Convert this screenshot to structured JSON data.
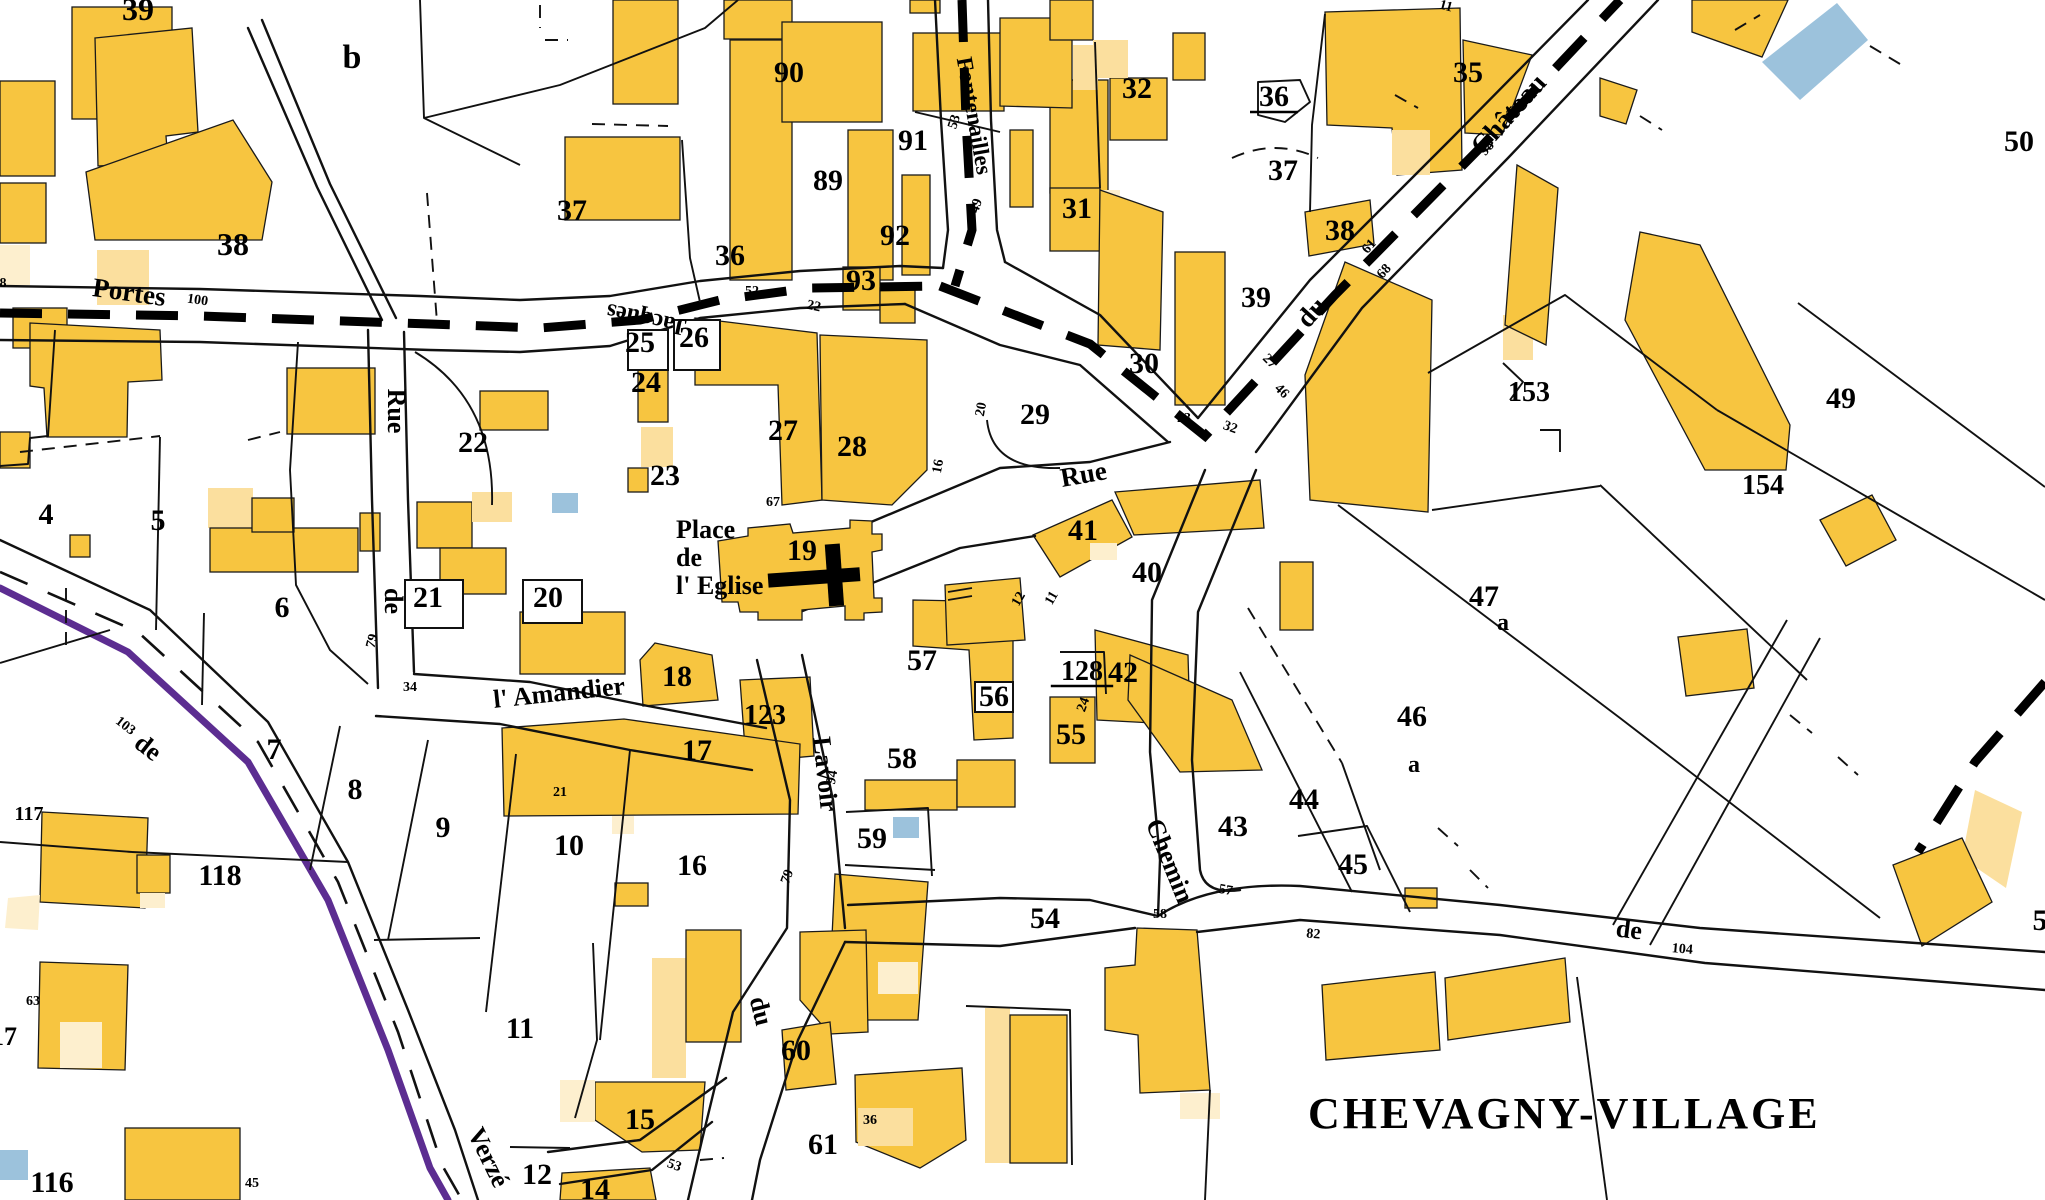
{
  "map": {
    "title": "CHEVAGNY-VILLAGE",
    "colors": {
      "building": "#F7C540",
      "building_light": "#FBDF9E",
      "building_pale": "#FDEFCE",
      "water": "#9CC2DC",
      "commune_boundary": "#5C2D91",
      "line": "#111111"
    },
    "place": {
      "lines": [
        "Place",
        "de",
        "l' Eglise"
      ]
    },
    "parcel_labels": [
      {
        "t": "39",
        "x": 138,
        "y": 20,
        "s": 32
      },
      {
        "t": "b",
        "x": 352,
        "y": 68,
        "s": 34
      },
      {
        "t": "38",
        "x": 233,
        "y": 255,
        "s": 32
      },
      {
        "t": "37",
        "x": 572,
        "y": 220
      },
      {
        "t": "37",
        "x": 1283,
        "y": 180
      },
      {
        "t": "32",
        "x": 1137,
        "y": 98
      },
      {
        "t": "36",
        "x": 1274,
        "y": 106,
        "u": 1
      },
      {
        "t": "35",
        "x": 1468,
        "y": 82
      },
      {
        "t": "38",
        "x": 1340,
        "y": 240
      },
      {
        "t": "31",
        "x": 1077,
        "y": 218
      },
      {
        "t": "39",
        "x": 1256,
        "y": 307
      },
      {
        "t": "30",
        "x": 1144,
        "y": 373
      },
      {
        "t": "90",
        "x": 789,
        "y": 82
      },
      {
        "t": "91",
        "x": 913,
        "y": 150
      },
      {
        "t": "89",
        "x": 828,
        "y": 190
      },
      {
        "t": "92",
        "x": 895,
        "y": 245
      },
      {
        "t": "93",
        "x": 861,
        "y": 290
      },
      {
        "t": "36",
        "x": 730,
        "y": 265
      },
      {
        "t": "25",
        "x": 640,
        "y": 352
      },
      {
        "t": "26",
        "x": 694,
        "y": 347
      },
      {
        "t": "24",
        "x": 646,
        "y": 392
      },
      {
        "t": "23",
        "x": 665,
        "y": 485
      },
      {
        "t": "27",
        "x": 783,
        "y": 440
      },
      {
        "t": "28",
        "x": 852,
        "y": 456
      },
      {
        "t": "29",
        "x": 1035,
        "y": 424
      },
      {
        "t": "22",
        "x": 473,
        "y": 452
      },
      {
        "t": "21",
        "x": 428,
        "y": 607
      },
      {
        "t": "20",
        "x": 548,
        "y": 607
      },
      {
        "t": "19",
        "x": 802,
        "y": 560
      },
      {
        "t": "18",
        "x": 677,
        "y": 686
      },
      {
        "t": "123",
        "x": 765,
        "y": 724,
        "s": 28
      },
      {
        "t": "17",
        "x": 697,
        "y": 760
      },
      {
        "t": "57",
        "x": 922,
        "y": 670
      },
      {
        "t": "56",
        "x": 994,
        "y": 706
      },
      {
        "t": "58",
        "x": 902,
        "y": 768
      },
      {
        "t": "55",
        "x": 1071,
        "y": 744
      },
      {
        "t": "128",
        "x": 1082,
        "y": 680,
        "s": 28,
        "u": 1
      },
      {
        "t": "42",
        "x": 1123,
        "y": 682
      },
      {
        "t": "41",
        "x": 1083,
        "y": 540
      },
      {
        "t": "40",
        "x": 1147,
        "y": 582
      },
      {
        "t": "153",
        "x": 1529,
        "y": 401,
        "s": 28
      },
      {
        "t": "154",
        "x": 1763,
        "y": 494,
        "s": 28
      },
      {
        "t": "49",
        "x": 1841,
        "y": 408
      },
      {
        "t": "50",
        "x": 2019,
        "y": 151
      },
      {
        "t": "47",
        "x": 1484,
        "y": 606
      },
      {
        "t": "a",
        "x": 1503,
        "y": 630,
        "s": 24
      },
      {
        "t": "46",
        "x": 1412,
        "y": 726
      },
      {
        "t": "a",
        "x": 1414,
        "y": 772,
        "s": 24
      },
      {
        "t": "43",
        "x": 1233,
        "y": 836
      },
      {
        "t": "44",
        "x": 1304,
        "y": 809
      },
      {
        "t": "45",
        "x": 1353,
        "y": 874
      },
      {
        "t": "59",
        "x": 872,
        "y": 848
      },
      {
        "t": "16",
        "x": 692,
        "y": 875
      },
      {
        "t": "10",
        "x": 569,
        "y": 855
      },
      {
        "t": "54",
        "x": 1045,
        "y": 928
      },
      {
        "t": "60",
        "x": 796,
        "y": 1060
      },
      {
        "t": "61",
        "x": 823,
        "y": 1154
      },
      {
        "t": "15",
        "x": 640,
        "y": 1129
      },
      {
        "t": "14",
        "x": 595,
        "y": 1199
      },
      {
        "t": "12",
        "x": 537,
        "y": 1184
      },
      {
        "t": "11",
        "x": 520,
        "y": 1038
      },
      {
        "t": "9",
        "x": 443,
        "y": 837
      },
      {
        "t": "8",
        "x": 355,
        "y": 799
      },
      {
        "t": "7",
        "x": 274,
        "y": 759
      },
      {
        "t": "6",
        "x": 282,
        "y": 617
      },
      {
        "t": "5",
        "x": 158,
        "y": 530
      },
      {
        "t": "4",
        "x": 46,
        "y": 524
      },
      {
        "t": "117",
        "x": 29,
        "y": 820,
        "s": 20
      },
      {
        "t": "118",
        "x": 220,
        "y": 885
      },
      {
        "t": "116",
        "x": 52,
        "y": 1192
      },
      {
        "t": "17",
        "x": 4,
        "y": 1045,
        "s": 26
      },
      {
        "t": "5",
        "x": 2040,
        "y": 930
      }
    ],
    "street_labels": [
      {
        "t": "Portes",
        "x": 128,
        "y": 301,
        "r": 8,
        "s": 27
      },
      {
        "t": "Jacques",
        "x": 648,
        "y": 312,
        "r": 192,
        "s": 24
      },
      {
        "t": "Fontenailles",
        "x": 967,
        "y": 117,
        "r": 80,
        "s": 23
      },
      {
        "t": "Rue",
        "x": 1085,
        "y": 483,
        "r": -10,
        "s": 27
      },
      {
        "t": "du",
        "x": 1318,
        "y": 318,
        "r": -48,
        "s": 27
      },
      {
        "t": "Château",
        "x": 1515,
        "y": 120,
        "r": -48,
        "s": 27
      },
      {
        "t": "Rue",
        "x": 388,
        "y": 411,
        "r": 90,
        "s": 26
      },
      {
        "t": "de",
        "x": 385,
        "y": 601,
        "r": 90,
        "s": 26
      },
      {
        "t": "l' Amandier",
        "x": 560,
        "y": 701,
        "r": -6,
        "s": 26
      },
      {
        "t": "Lavoir",
        "x": 817,
        "y": 775,
        "r": 84,
        "s": 26
      },
      {
        "t": "du",
        "x": 753,
        "y": 1013,
        "r": 76,
        "s": 26
      },
      {
        "t": "Chemin",
        "x": 1162,
        "y": 864,
        "r": 68,
        "s": 26
      },
      {
        "t": "de",
        "x": 1628,
        "y": 938,
        "r": 7,
        "s": 26
      },
      {
        "t": "de",
        "x": 143,
        "y": 754,
        "r": 38,
        "s": 26
      },
      {
        "t": "Verzé",
        "x": 481,
        "y": 1161,
        "r": 64,
        "s": 26
      }
    ],
    "small_numbers": [
      {
        "t": "138",
        "x": -4,
        "y": 287
      },
      {
        "t": "100",
        "x": 197,
        "y": 304,
        "r": 8
      },
      {
        "t": "103",
        "x": 123,
        "y": 729,
        "r": 38
      },
      {
        "t": "53",
        "x": 958,
        "y": 123,
        "r": -72
      },
      {
        "t": "49",
        "x": 980,
        "y": 207,
        "r": -72
      },
      {
        "t": "52",
        "x": 752,
        "y": 295
      },
      {
        "t": "22",
        "x": 813,
        "y": 310,
        "r": 12
      },
      {
        "t": "11",
        "x": 1445,
        "y": 10,
        "r": 15
      },
      {
        "t": "98",
        "x": 1490,
        "y": 151,
        "r": -48
      },
      {
        "t": "68",
        "x": 1387,
        "y": 274,
        "r": -48
      },
      {
        "t": "61",
        "x": 1372,
        "y": 249,
        "r": -48
      },
      {
        "t": "23",
        "x": 1184,
        "y": 422
      },
      {
        "t": "32",
        "x": 1229,
        "y": 431,
        "r": 20
      },
      {
        "t": "46",
        "x": 1279,
        "y": 394,
        "r": 45
      },
      {
        "t": "27",
        "x": 1267,
        "y": 364,
        "r": 45
      },
      {
        "t": "20",
        "x": 985,
        "y": 410,
        "r": -80
      },
      {
        "t": "16",
        "x": 942,
        "y": 467,
        "r": -80
      },
      {
        "t": "67",
        "x": 773,
        "y": 506
      },
      {
        "t": "12",
        "x": 1022,
        "y": 601,
        "r": -60
      },
      {
        "t": "11",
        "x": 1055,
        "y": 600,
        "r": -60
      },
      {
        "t": "79",
        "x": 376,
        "y": 642,
        "r": -75
      },
      {
        "t": "34",
        "x": 410,
        "y": 691
      },
      {
        "t": "21",
        "x": 560,
        "y": 796
      },
      {
        "t": "94",
        "x": 836,
        "y": 778,
        "r": -80
      },
      {
        "t": "79",
        "x": 791,
        "y": 878,
        "r": -70
      },
      {
        "t": "24",
        "x": 1087,
        "y": 706,
        "r": -70
      },
      {
        "t": "57",
        "x": 1225,
        "y": 894,
        "r": 10
      },
      {
        "t": "58",
        "x": 1160,
        "y": 918
      },
      {
        "t": "82",
        "x": 1313,
        "y": 938,
        "r": 5
      },
      {
        "t": "36",
        "x": 870,
        "y": 1124
      },
      {
        "t": "53",
        "x": 673,
        "y": 1169,
        "r": 20
      },
      {
        "t": "104",
        "x": 1682,
        "y": 953,
        "r": 5
      },
      {
        "t": "45",
        "x": 252,
        "y": 1187
      },
      {
        "t": "63",
        "x": 33,
        "y": 1005
      }
    ]
  }
}
